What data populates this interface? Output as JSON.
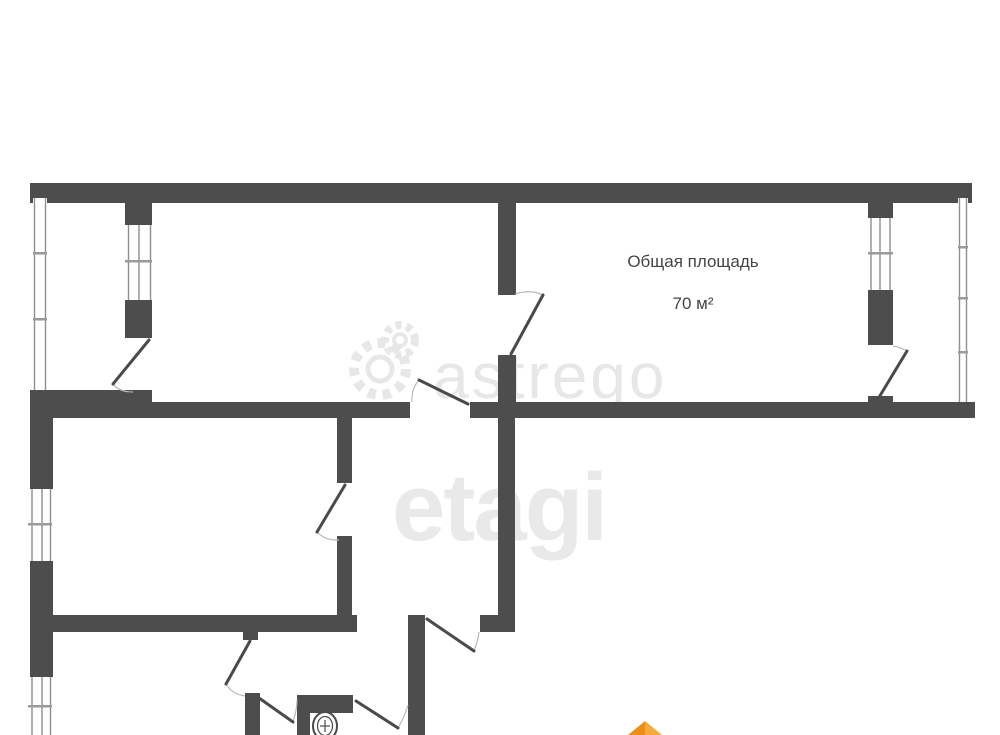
{
  "labels": {
    "area_title": "Общая площадь",
    "area_value": "70 м²"
  },
  "watermarks": {
    "brand1": "astrego",
    "brand2": "etagi"
  },
  "colors": {
    "wall": "#4d4d4d",
    "window_line": "#8f8f8f",
    "window_tick": "#9a9a9a",
    "door": "#4a4a4a",
    "arc": "#b8b8b8",
    "watermark": "#e7e7e7",
    "label": "#454545",
    "logo_orange_dark": "#ef8e16",
    "logo_orange_light": "#f6a93c"
  },
  "floorplan": {
    "walls": [
      {
        "name": "top-exterior",
        "x": 30,
        "y": 183,
        "w": 942,
        "h": 20
      },
      {
        "name": "left-balcony-divider-top",
        "x": 125,
        "y": 183,
        "w": 27,
        "h": 42
      },
      {
        "name": "left-balcony-divider-mid",
        "x": 125,
        "y": 300,
        "w": 27,
        "h": 38
      },
      {
        "name": "top-rooms-divider-upper",
        "x": 498,
        "y": 183,
        "w": 18,
        "h": 112
      },
      {
        "name": "top-rooms-divider-lower",
        "x": 498,
        "y": 355,
        "w": 18,
        "h": 48
      },
      {
        "name": "right-room-wall-top",
        "x": 868,
        "y": 197,
        "w": 25,
        "h": 21
      },
      {
        "name": "right-room-wall-mid",
        "x": 868,
        "y": 290,
        "w": 25,
        "h": 55
      },
      {
        "name": "right-room-wall-stub",
        "x": 868,
        "y": 396,
        "w": 25,
        "h": 7
      },
      {
        "name": "left-balcony-bottom",
        "x": 30,
        "y": 390,
        "w": 122,
        "h": 16
      },
      {
        "name": "band-bottom-left",
        "x": 30,
        "y": 402,
        "w": 380,
        "h": 16
      },
      {
        "name": "band-bottom-right",
        "x": 470,
        "y": 402,
        "w": 505,
        "h": 16
      },
      {
        "name": "left-exterior-upper",
        "x": 30,
        "y": 403,
        "w": 23,
        "h": 86
      },
      {
        "name": "left-exterior-lower",
        "x": 30,
        "y": 561,
        "w": 23,
        "h": 116
      },
      {
        "name": "mid-divider-top",
        "x": 337,
        "y": 418,
        "w": 15,
        "h": 65
      },
      {
        "name": "mid-divider-bottom",
        "x": 337,
        "y": 536,
        "w": 15,
        "h": 81
      },
      {
        "name": "hall-right-wall",
        "x": 498,
        "y": 418,
        "w": 17,
        "h": 199
      },
      {
        "name": "hall-bottom-block",
        "x": 480,
        "y": 615,
        "w": 35,
        "h": 17
      },
      {
        "name": "mid-bottom-wall",
        "x": 30,
        "y": 615,
        "w": 327,
        "h": 17
      },
      {
        "name": "door-hinge-block",
        "x": 243,
        "y": 630,
        "w": 15,
        "h": 10
      },
      {
        "name": "lower-left-wall",
        "x": 245,
        "y": 693,
        "w": 15,
        "h": 42
      },
      {
        "name": "lower-right-wall",
        "x": 408,
        "y": 615,
        "w": 17,
        "h": 120
      },
      {
        "name": "wc-top-wall",
        "x": 297,
        "y": 695,
        "w": 56,
        "h": 18
      },
      {
        "name": "wc-left-wall",
        "x": 297,
        "y": 695,
        "w": 13,
        "h": 40
      }
    ],
    "windows": [
      {
        "name": "left-balcony-glazing",
        "x": 33,
        "y": 198,
        "w": 14,
        "h": 192,
        "lines": [
          34.5,
          45.5
        ],
        "ticks": [
          252,
          318
        ]
      },
      {
        "name": "left-balcony-room-window",
        "x": 125,
        "y": 225,
        "w": 27,
        "h": 75,
        "lines": [
          128.5,
          139,
          150.5
        ],
        "ticks": [
          260
        ]
      },
      {
        "name": "mid-room-window",
        "x": 28,
        "y": 489,
        "w": 24,
        "h": 72,
        "lines": [
          32,
          42,
          50.5
        ],
        "ticks": [
          523
        ]
      },
      {
        "name": "lower-room-window",
        "x": 28,
        "y": 677,
        "w": 24,
        "h": 58,
        "lines": [
          32,
          42,
          50.5
        ],
        "ticks": [
          705
        ]
      },
      {
        "name": "right-room-window",
        "x": 868,
        "y": 218,
        "w": 25,
        "h": 72,
        "lines": [
          871,
          880,
          890
        ],
        "ticks": [
          252
        ]
      },
      {
        "name": "right-balcony-glazing",
        "x": 958,
        "y": 198,
        "w": 10,
        "h": 204,
        "lines": [
          959.5,
          966.5
        ],
        "ticks": [
          246,
          297,
          351
        ]
      }
    ],
    "doors": [
      {
        "name": "left-balcony-door",
        "leaf": [
          149,
          340,
          113,
          384
        ],
        "arc": "M 113,384 Q 119,392 133,392"
      },
      {
        "name": "top-rooms-door",
        "leaf": [
          511,
          354,
          543,
          295
        ],
        "arc": "M 543,295 Q 531,289 515,294"
      },
      {
        "name": "room-to-hall-door",
        "leaf": [
          468,
          404,
          419,
          380
        ],
        "arc": "M 412,402 Q 411,389 419,380"
      },
      {
        "name": "mid-room-door",
        "leaf": [
          345,
          485,
          317,
          532
        ],
        "arc": "M 317,532 Q 326,541 339,540"
      },
      {
        "name": "right-balcony-door",
        "leaf": [
          878,
          399,
          907,
          351
        ],
        "arc": "M 907,351 Q 900,347 893,346"
      },
      {
        "name": "bottom-right-room-door",
        "leaf": [
          427,
          619,
          474,
          651
        ],
        "arc": "M 474,651 Q 478,640 479,632"
      },
      {
        "name": "lower-left-room-door",
        "leaf": [
          250,
          641,
          226,
          684
        ],
        "arc": "M 226,684 Q 232,694 245,696"
      },
      {
        "name": "wc-door",
        "leaf": [
          259,
          698,
          293,
          722
        ],
        "arc": "M 293,722 Q 297,710 297,700"
      },
      {
        "name": "bath-door",
        "leaf": [
          356,
          701,
          398,
          728
        ],
        "arc": "M 398,728 Q 405,716 408,705"
      }
    ],
    "fixtures": {
      "toilet": {
        "cx": 325,
        "cy": 726,
        "rx": 12,
        "ry": 14,
        "inner_rx": 7.5,
        "inner_ry": 9.5
      }
    },
    "watermark_gears": [
      {
        "cx": 380,
        "cy": 369,
        "r": 26,
        "w": 10,
        "dash": "8 7",
        "inner_r": 12,
        "inner_w": 5
      },
      {
        "cx": 400,
        "cy": 340,
        "r": 15,
        "w": 8,
        "dash": "6 5",
        "inner_r": 6,
        "inner_w": 4
      }
    ],
    "logo_triangles": [
      {
        "name": "logo-triangle-left",
        "points": "628,735 645,721 645,735",
        "fill": "logo_orange_dark"
      },
      {
        "name": "logo-triangle-right",
        "points": "645,721 662,735 645,735",
        "fill": "logo_orange_light"
      }
    ]
  }
}
